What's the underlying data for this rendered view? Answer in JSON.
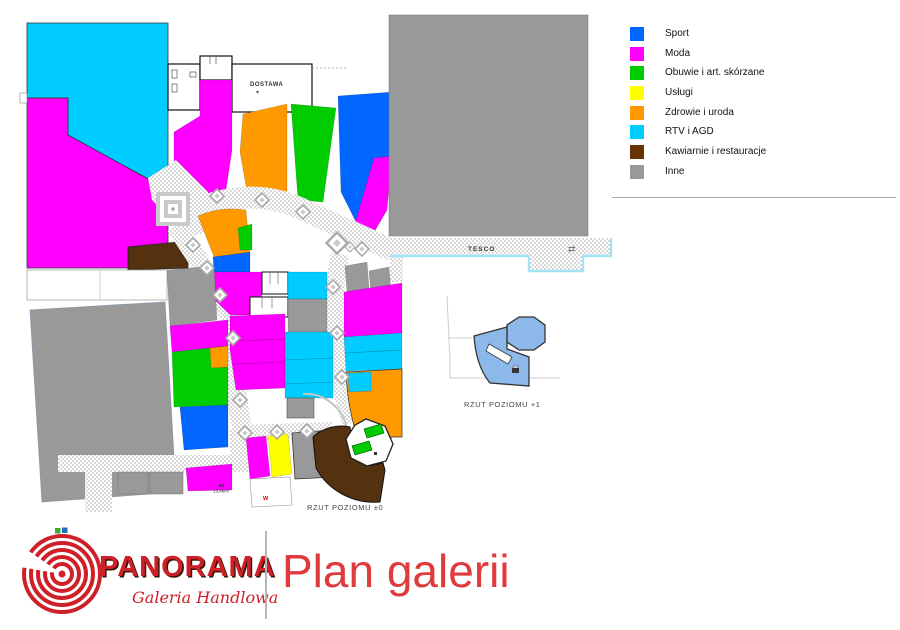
{
  "legend": {
    "items": [
      {
        "key": "sport",
        "label": "Sport",
        "color": "#0066ff"
      },
      {
        "key": "moda",
        "label": "Moda",
        "color": "#ff00ff"
      },
      {
        "key": "obuwie",
        "label": "Obuwie i art. skórzane",
        "color": "#00cc00"
      },
      {
        "key": "uslugi",
        "label": "Usługi",
        "color": "#ffff00"
      },
      {
        "key": "zdrowie",
        "label": "Zdrowie i uroda",
        "color": "#ff9900"
      },
      {
        "key": "rtv",
        "label": "RTV i AGD",
        "color": "#00ccff"
      },
      {
        "key": "kawiarnie",
        "label": "Kawiarnie i restauracje",
        "color": "#663300"
      },
      {
        "key": "inne",
        "label": "Inne",
        "color": "#999999"
      }
    ]
  },
  "palette_extra": {
    "kawiarnie_dark": "#54320f",
    "level1": "#8cb9e9",
    "corridor": "#d9d9d9",
    "cyan_line": "#a5e2f5",
    "wall": "#333333",
    "title_red": "#e03a3c",
    "logo_red": "#cf2027",
    "logo_green": "#3aaa35",
    "logo_blue": "#1f6fc4",
    "divider": "#b5b5b5"
  },
  "plan": {
    "labels": {
      "tesco": "TESCO",
      "dostawa": "DOSTAWA",
      "level0_caption": "RZUT POZIOMU ±0",
      "level1_caption": "RZUT POZIOMU +1",
      "unit_number": "80",
      "unit_area": "13,46m²",
      "wc_marker": "W",
      "exit_arrow": "⇄"
    }
  },
  "footer": {
    "brand": "PANORAMA",
    "tagline": "Galeria Handlowa",
    "page_title": "Plan galerii"
  }
}
